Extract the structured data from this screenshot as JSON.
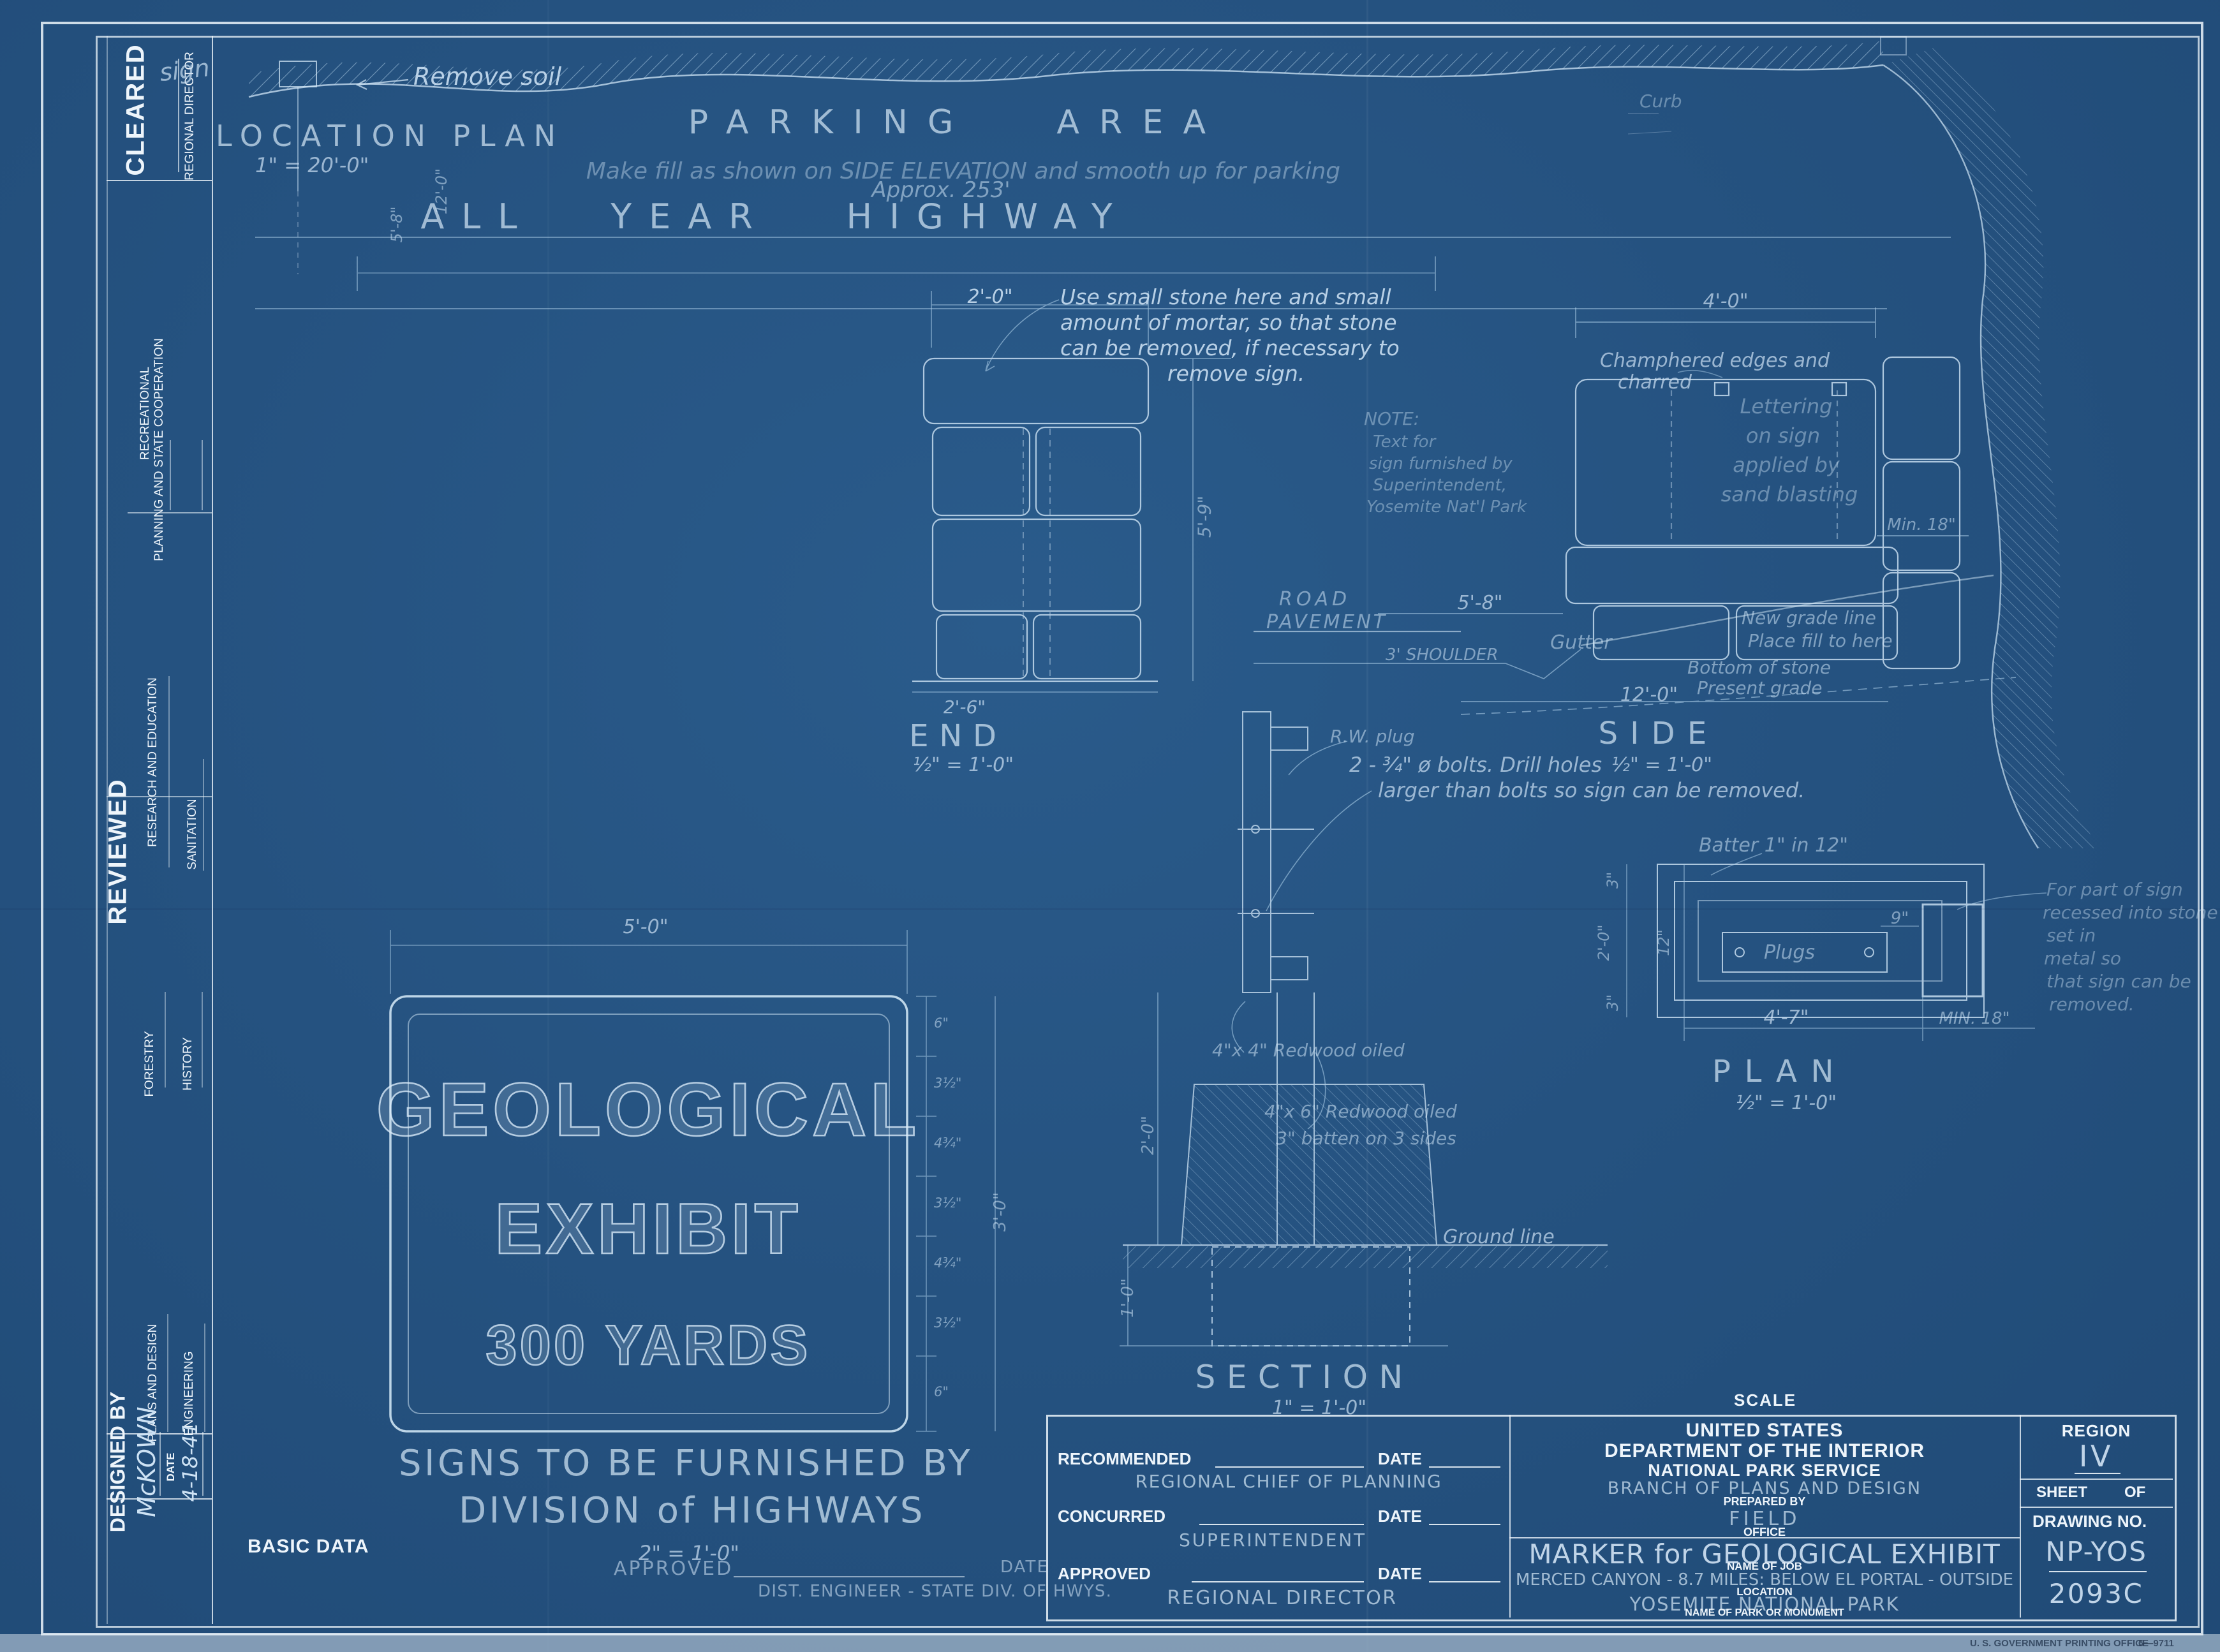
{
  "colors": {
    "paper": "#255280",
    "ink": "#ecf4fa",
    "pencil": "#cde2f4"
  },
  "sidebar": {
    "cleared_label": "CLEARED",
    "cleared_signatory": "REGIONAL DIRECTOR",
    "row_recreational": "RECREATIONAL",
    "row_planning": "PLANNING AND STATE COOPERATION",
    "reviewed_label": "REVIEWED",
    "row_research": "RESEARCH AND EDUCATION",
    "row_sanitation": "SANITATION",
    "row_forestry": "FORESTRY",
    "row_history": "HISTORY",
    "row_plans": "PLANS AND DESIGN",
    "row_engineering": "ENGINEERING",
    "designed_by_label": "DESIGNED BY",
    "designed_by_name": "McKOWN",
    "date_label": "DATE",
    "date_value": "4-18-41"
  },
  "location_plan": {
    "title": "LOCATION PLAN",
    "scale": "1\" = 20'-0\"",
    "sign_label": "sign",
    "remove_soil": "Remove soil",
    "parking_area": "PARKING AREA",
    "fill_note": "Make fill as shown on SIDE ELEVATION and smooth up for parking",
    "approx_dim": "Approx. 253'",
    "highway": "ALL YEAR HIGHWAY",
    "curb_note": "Curb",
    "dim_offset": "5'-8\"",
    "dim_setback": "12'-0\""
  },
  "end_view": {
    "title": "END",
    "scale": "½\" = 1'-0\"",
    "dim_top": "2'-0\"",
    "dim_height": "5'-9\"",
    "dim_bottom": "2'-6\"",
    "note_l1": "Use small stone here and small",
    "note_l2": "amount of mortar, so that stone",
    "note_l3": "can be removed, if necessary to",
    "note_l4": "remove sign."
  },
  "general_note": {
    "l1": "NOTE:",
    "l2": "Text for",
    "l3": "sign furnished by",
    "l4": "Superintendent,",
    "l5": "Yosemite Nat'l Park"
  },
  "side_view": {
    "title": "SIDE",
    "scale": "½\" = 1'-0\"",
    "dim_top": "4'-0\"",
    "chamfer_l1": "Champhered edges and",
    "chamfer_l2": "charred",
    "lettering_l1": "Lettering",
    "lettering_l2": "on sign",
    "lettering_l3": "applied by",
    "lettering_l4": "sand blasting",
    "dim_min": "Min. 18\"",
    "road_l1": "ROAD",
    "road_l2": "PAVEMENT",
    "dim_shoulder_span": "5'-8\"",
    "shoulder": "3' SHOULDER",
    "gutter": "Gutter",
    "new_grade": "New grade line",
    "place_fill": "Place fill to here",
    "bottom_of_stone": "Bottom of stone",
    "dim_span": "12'-0\"",
    "present_grade": "Present grade"
  },
  "section_view": {
    "title": "SECTION",
    "scale": "1\" = 1'-0\"",
    "plug_note": "R.W. plug",
    "bolts_l1": "2 - ¾\" ø bolts. Drill holes",
    "bolts_l2": "larger than bolts so sign can be removed.",
    "redwood_a": "4\"x 4\" Redwood oiled",
    "redwood_b": "4\"x 6\" Redwood oiled",
    "batten": "3\" batten on 3 sides",
    "ground_line": "Ground line",
    "dim_depth": "2'-0\"",
    "dim_footing": "1'-0\""
  },
  "plan_view": {
    "title": "PLAN",
    "scale": "½\" = 1'-0\"",
    "batter_note": "Batter 1\" in 12\"",
    "plugs": "Plugs",
    "dim_9": "9\"",
    "dim_width": "4'-7\"",
    "dim_min": "MIN. 18\"",
    "dim_3a": "3\"",
    "dim_center": "2'-0\"",
    "dim_3b": "3\"",
    "dim_12": "12\"",
    "recess_l1": "For part of sign",
    "recess_l2": "recessed into stone",
    "recess_l3": "set in",
    "recess_l4": "metal so",
    "recess_l5": "that sign can be",
    "recess_l6": "removed."
  },
  "sign_face": {
    "line1": "GEOLOGICAL",
    "line2": "EXHIBIT",
    "line3": "300 YARDS",
    "dim_width": "5'-0\"",
    "dim_height": "3'-0\"",
    "row_dims": [
      "6\"",
      "3½\"",
      "4¾\"",
      "3½\"",
      "4¾\"",
      "3½\"",
      "6\""
    ],
    "furnish_l1": "SIGNS TO BE FURNISHED BY",
    "furnish_l2": "DIVISION of HIGHWAYS",
    "furnish_scale": "2\" = 1'-0\""
  },
  "footer": {
    "basic_data": "BASIC DATA",
    "approved_label": "APPROVED",
    "date_label": "DATE",
    "dist_engineer": "DIST. ENGINEER - STATE DIV. OF HWYS.",
    "scale_label": "SCALE",
    "printing_office": "U. S. GOVERNMENT PRINTING OFFICE",
    "print_code": "6—9711"
  },
  "approvals": {
    "rows": [
      {
        "label": "RECOMMENDED",
        "date_label": "DATE",
        "signatory": "REGIONAL CHIEF OF PLANNING"
      },
      {
        "label": "CONCURRED",
        "date_label": "DATE",
        "signatory": "SUPERINTENDENT"
      },
      {
        "label": "APPROVED",
        "date_label": "DATE",
        "signatory": "REGIONAL DIRECTOR"
      }
    ]
  },
  "title_block": {
    "dept_l1": "UNITED STATES",
    "dept_l2": "DEPARTMENT OF THE INTERIOR",
    "dept_l3": "NATIONAL PARK SERVICE",
    "branch": "BRANCH OF PLANS AND DESIGN",
    "prepared_by_label": "PREPARED BY",
    "office_value": "FIELD",
    "office_label": "OFFICE",
    "job_title": "MARKER for GEOLOGICAL EXHIBIT",
    "job_label": "NAME OF JOB",
    "location_value": "MERCED CANYON - 8.7 MILES: BELOW EL PORTAL - OUTSIDE",
    "location_label": "LOCATION",
    "park_value": "YOSEMITE NATIONAL PARK",
    "park_label": "NAME OF PARK OR MONUMENT",
    "region_label": "REGION",
    "region_value": "IV",
    "sheet_label": "SHEET",
    "of_label": "OF",
    "drawing_no_label": "DRAWING NO.",
    "drawing_no_line1": "NP-YOS",
    "drawing_no_line2": "2093C"
  }
}
